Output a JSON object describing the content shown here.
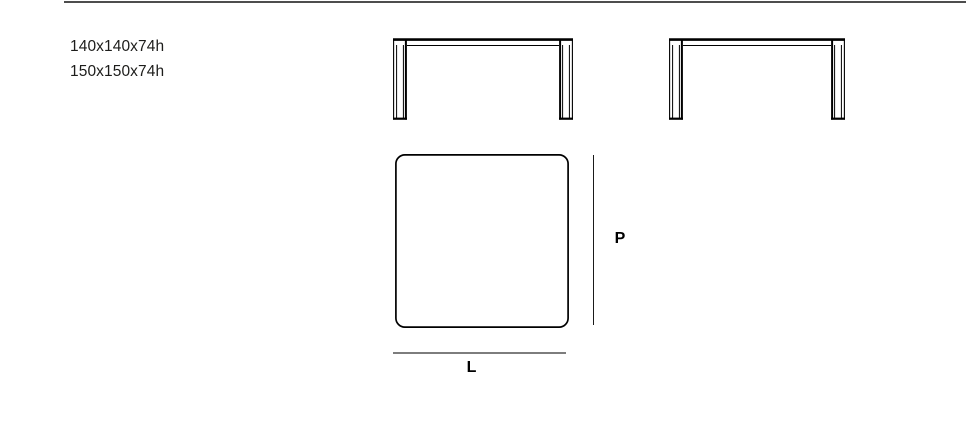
{
  "page": {
    "background_color": "#ffffff",
    "top_rule_color": "#4d4d4d"
  },
  "specs": {
    "line1": "140x140x74h",
    "line2": "150x150x74h",
    "text_color": "#1d1d1b"
  },
  "dimension_labels": {
    "depth": "P",
    "length": "L"
  },
  "colors": {
    "outline": "#000000",
    "depth_dimension_line": "#1a1a1a",
    "length_dimension_line": "#7d7d7d"
  },
  "drawings": {
    "front_view_left": "table-front-elevation",
    "front_view_right": "table-front-elevation",
    "top_view": "square-table-top-plan"
  }
}
